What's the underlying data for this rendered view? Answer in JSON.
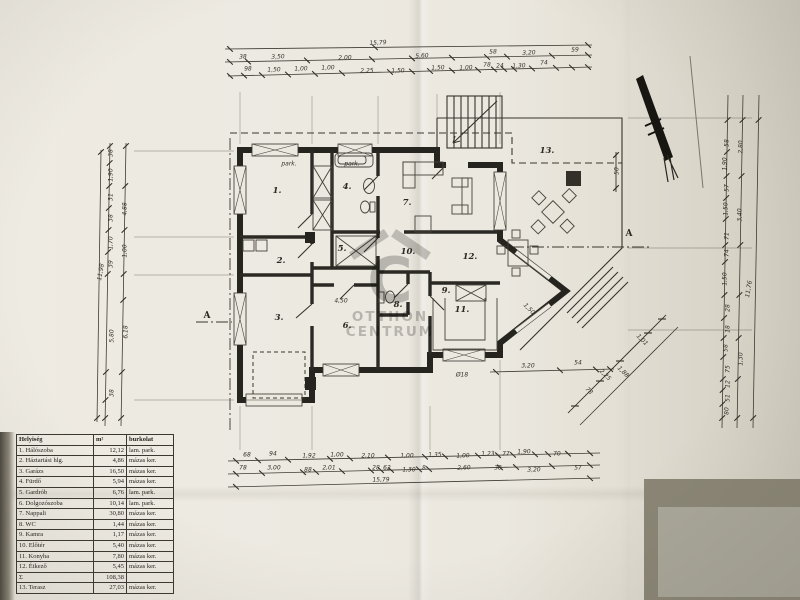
{
  "watermark": {
    "glyph": "C",
    "line1": "OTTHON",
    "line2": "CENTRUM"
  },
  "legend_table": {
    "headers": [
      "Helyiség",
      "m²",
      "burkolat"
    ],
    "rows": [
      [
        "1. Hálószoba",
        "12,12",
        "lam. park."
      ],
      [
        "2. Háztartási hlg.",
        "4,86",
        "mázas ker."
      ],
      [
        "3. Garázs",
        "16,50",
        "mázas ker."
      ],
      [
        "4. Fürdő",
        "5,94",
        "mázas ker."
      ],
      [
        "5. Gardrób",
        "6,76",
        "lam. park."
      ],
      [
        "6. Dolgozószoba",
        "10,14",
        "lam. park."
      ],
      [
        "7. Nappali",
        "30,80",
        "mázas ker."
      ],
      [
        "8. WC",
        "1,44",
        "mázas ker."
      ],
      [
        "9. Kamra",
        "1,17",
        "mázas ker."
      ],
      [
        "10. Előtér",
        "5,40",
        "mázas ker."
      ],
      [
        "11. Konyha",
        "7,80",
        "mázas ker."
      ],
      [
        "12. Étkező",
        "5,45",
        "mázas ker."
      ],
      [
        "Σ",
        "108,38",
        ""
      ],
      [
        "13. Terasz",
        "27,03",
        "mázas ker."
      ]
    ]
  },
  "room_labels": [
    {
      "t": "1.",
      "x": 277,
      "y": 191
    },
    {
      "t": "2.",
      "x": 281,
      "y": 261
    },
    {
      "t": "3.",
      "x": 279,
      "y": 318
    },
    {
      "t": "4.",
      "x": 347,
      "y": 187
    },
    {
      "t": "5.",
      "x": 342,
      "y": 249
    },
    {
      "t": "6.",
      "x": 347,
      "y": 326
    },
    {
      "t": "7.",
      "x": 407,
      "y": 203
    },
    {
      "t": "8.",
      "x": 398,
      "y": 305
    },
    {
      "t": "9.",
      "x": 446,
      "y": 291
    },
    {
      "t": "10.",
      "x": 408,
      "y": 252
    },
    {
      "t": "11.",
      "x": 462,
      "y": 310
    },
    {
      "t": "12.",
      "x": 470,
      "y": 257
    },
    {
      "t": "13.",
      "x": 547,
      "y": 151
    }
  ],
  "section_labels": [
    {
      "t": "A",
      "x": 207,
      "y": 316
    },
    {
      "t": "A",
      "x": 629,
      "y": 234
    }
  ],
  "dim_labels": [
    {
      "t": "15,79",
      "x": 378,
      "y": 43,
      "r": -3
    },
    {
      "t": "38",
      "x": 243,
      "y": 57,
      "r": -2
    },
    {
      "t": "3,50",
      "x": 278,
      "y": 57,
      "r": -2
    },
    {
      "t": "2,00",
      "x": 345,
      "y": 58,
      "r": -2
    },
    {
      "t": "5,60",
      "x": 422,
      "y": 56,
      "r": -3
    },
    {
      "t": "58",
      "x": 493,
      "y": 52,
      "r": -3
    },
    {
      "t": "3,20",
      "x": 529,
      "y": 53,
      "r": -3
    },
    {
      "t": "59",
      "x": 575,
      "y": 50,
      "r": -3
    },
    {
      "t": "98",
      "x": 248,
      "y": 69,
      "r": -2
    },
    {
      "t": "1,50",
      "x": 274,
      "y": 70,
      "r": -2
    },
    {
      "t": "1,00",
      "x": 301,
      "y": 69,
      "r": -2
    },
    {
      "t": "1,00",
      "x": 328,
      "y": 68,
      "r": -2
    },
    {
      "t": "2,25",
      "x": 367,
      "y": 71,
      "r": -2
    },
    {
      "t": "1,50",
      "x": 398,
      "y": 71,
      "r": -2
    },
    {
      "t": "1,50",
      "x": 438,
      "y": 68,
      "r": -3
    },
    {
      "t": "1,00",
      "x": 466,
      "y": 68,
      "r": -3
    },
    {
      "t": "78",
      "x": 487,
      "y": 65,
      "r": -3
    },
    {
      "t": "24",
      "x": 500,
      "y": 66,
      "r": -3
    },
    {
      "t": "1,30",
      "x": 519,
      "y": 66,
      "r": -3
    },
    {
      "t": "74",
      "x": 544,
      "y": 63,
      "r": -3
    },
    {
      "t": "68",
      "x": 247,
      "y": 455,
      "r": 0
    },
    {
      "t": "94",
      "x": 273,
      "y": 454,
      "r": 0
    },
    {
      "t": "1,92",
      "x": 309,
      "y": 456,
      "r": 0
    },
    {
      "t": "1,00",
      "x": 337,
      "y": 455,
      "r": 0
    },
    {
      "t": "2,10",
      "x": 368,
      "y": 456,
      "r": 0
    },
    {
      "t": "1,00",
      "x": 407,
      "y": 456,
      "r": 0
    },
    {
      "t": "1,35",
      "x": 435,
      "y": 455,
      "r": -2
    },
    {
      "t": "1,00",
      "x": 463,
      "y": 456,
      "r": -2
    },
    {
      "t": "1,23",
      "x": 488,
      "y": 454,
      "r": -2
    },
    {
      "t": "77",
      "x": 506,
      "y": 454,
      "r": -2
    },
    {
      "t": "1,90",
      "x": 524,
      "y": 452,
      "r": -2
    },
    {
      "t": "70",
      "x": 557,
      "y": 454,
      "r": -2
    },
    {
      "t": "78",
      "x": 243,
      "y": 468,
      "r": 0
    },
    {
      "t": "3,00",
      "x": 274,
      "y": 468,
      "r": 0
    },
    {
      "t": "88",
      "x": 308,
      "y": 470,
      "r": 0
    },
    {
      "t": "2,01",
      "x": 329,
      "y": 468,
      "r": 0
    },
    {
      "t": "28",
      "x": 376,
      "y": 468,
      "r": 0
    },
    {
      "t": "62",
      "x": 387,
      "y": 468,
      "r": 0
    },
    {
      "t": "1,30",
      "x": 409,
      "y": 470,
      "r": 0
    },
    {
      "t": "8",
      "x": 424,
      "y": 468,
      "r": -2
    },
    {
      "t": "2,60",
      "x": 464,
      "y": 468,
      "r": -2
    },
    {
      "t": "38",
      "x": 498,
      "y": 468,
      "r": -2
    },
    {
      "t": "3,20",
      "x": 534,
      "y": 470,
      "r": -2
    },
    {
      "t": "57",
      "x": 578,
      "y": 468,
      "r": -2
    },
    {
      "t": "15,79",
      "x": 381,
      "y": 480,
      "r": -2
    },
    {
      "t": "38",
      "x": 111,
      "y": 153,
      "r": -90
    },
    {
      "t": "1,90",
      "x": 111,
      "y": 175,
      "r": -90
    },
    {
      "t": "31",
      "x": 111,
      "y": 197,
      "r": -90
    },
    {
      "t": "38",
      "x": 111,
      "y": 218,
      "r": -90
    },
    {
      "t": "1,70",
      "x": 111,
      "y": 243,
      "r": -90
    },
    {
      "t": "39",
      "x": 111,
      "y": 264,
      "r": -90
    },
    {
      "t": "5,80",
      "x": 112,
      "y": 336,
      "r": -90
    },
    {
      "t": "38",
      "x": 112,
      "y": 393,
      "r": -90
    },
    {
      "t": "4,88",
      "x": 125,
      "y": 209,
      "r": -90
    },
    {
      "t": "1,00",
      "x": 125,
      "y": 251,
      "r": -90
    },
    {
      "t": "6,18",
      "x": 126,
      "y": 332,
      "r": -90
    },
    {
      "t": "11,98",
      "x": 101,
      "y": 272,
      "r": -80
    },
    {
      "t": "58",
      "x": 727,
      "y": 143,
      "r": -90
    },
    {
      "t": "1,90",
      "x": 725,
      "y": 164,
      "r": -90
    },
    {
      "t": "57",
      "x": 727,
      "y": 188,
      "r": -90
    },
    {
      "t": "1,50",
      "x": 726,
      "y": 209,
      "r": -90
    },
    {
      "t": "71",
      "x": 727,
      "y": 236,
      "r": -90
    },
    {
      "t": "74",
      "x": 727,
      "y": 253,
      "r": -90
    },
    {
      "t": "1,50",
      "x": 725,
      "y": 279,
      "r": -90
    },
    {
      "t": "28",
      "x": 728,
      "y": 308,
      "r": -90
    },
    {
      "t": "18",
      "x": 728,
      "y": 329,
      "r": -90
    },
    {
      "t": "58",
      "x": 726,
      "y": 348,
      "r": -90
    },
    {
      "t": "75",
      "x": 728,
      "y": 369,
      "r": -90
    },
    {
      "t": "12",
      "x": 728,
      "y": 384,
      "r": -90
    },
    {
      "t": "51",
      "x": 728,
      "y": 398,
      "r": -90
    },
    {
      "t": "80",
      "x": 727,
      "y": 411,
      "r": -90
    },
    {
      "t": "2,80",
      "x": 741,
      "y": 147,
      "r": -90
    },
    {
      "t": "3,40",
      "x": 740,
      "y": 215,
      "r": -90
    },
    {
      "t": "11,76",
      "x": 749,
      "y": 289,
      "r": -80
    },
    {
      "t": "1,30",
      "x": 741,
      "y": 359,
      "r": -90
    },
    {
      "t": "3,20",
      "x": 528,
      "y": 366,
      "r": 0
    },
    {
      "t": "54",
      "x": 578,
      "y": 363,
      "r": 0
    },
    {
      "t": "73",
      "x": 589,
      "y": 391,
      "r": 45
    },
    {
      "t": "2,25",
      "x": 605,
      "y": 375,
      "r": 45
    },
    {
      "t": "1,88",
      "x": 623,
      "y": 372,
      "r": 45
    },
    {
      "t": "1,01",
      "x": 642,
      "y": 340,
      "r": 45
    },
    {
      "t": "50",
      "x": 617,
      "y": 171,
      "r": -90
    },
    {
      "t": "4,50",
      "x": 341,
      "y": 301,
      "r": 0
    },
    {
      "t": "Ø18",
      "x": 462,
      "y": 375,
      "r": 0
    },
    {
      "t": "1,50",
      "x": 529,
      "y": 309,
      "r": 45
    },
    {
      "t": "park.",
      "x": 289,
      "y": 164,
      "r": 0
    },
    {
      "t": "park.",
      "x": 352,
      "y": 164,
      "r": 0
    }
  ]
}
